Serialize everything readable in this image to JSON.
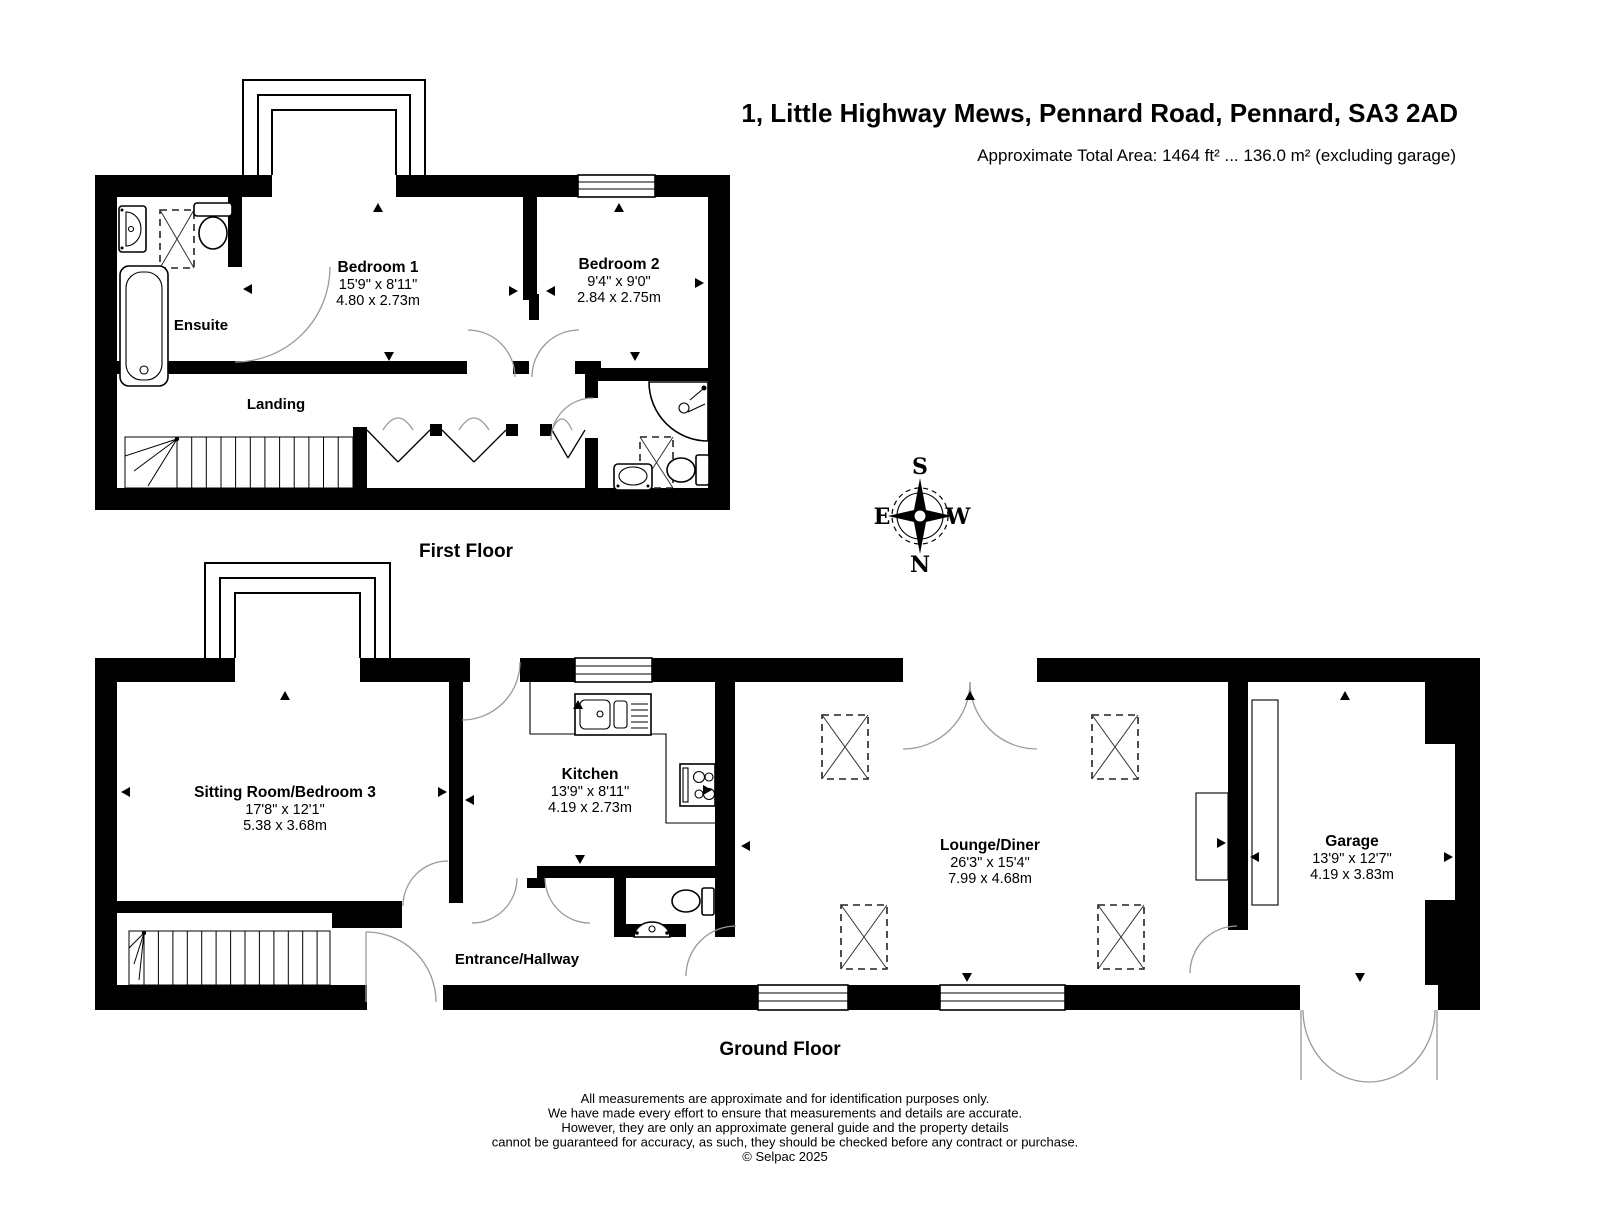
{
  "header": {
    "title": "1, Little Highway Mews, Pennard Road, Pennard, SA3 2AD",
    "area_note": "Approximate Total Area: 1464 ft² ... 136.0 m² (excluding garage)"
  },
  "compass": {
    "n": "N",
    "s": "S",
    "e": "E",
    "w": "W"
  },
  "first_floor": {
    "label": "First Floor",
    "bedroom1": {
      "name": "Bedroom 1",
      "imperial": "15'9\" x 8'11\"",
      "metric": "4.80 x 2.73m"
    },
    "bedroom2": {
      "name": "Bedroom 2",
      "imperial": "9'4\" x 9'0\"",
      "metric": "2.84 x 2.75m"
    },
    "ensuite": {
      "name": "Ensuite"
    },
    "landing": {
      "name": "Landing"
    }
  },
  "ground_floor": {
    "label": "Ground Floor",
    "sitting_room": {
      "name": "Sitting Room/Bedroom 3",
      "imperial": "17'8\" x 12'1\"",
      "metric": "5.38 x 3.68m"
    },
    "kitchen": {
      "name": "Kitchen",
      "imperial": "13'9\" x 8'11\"",
      "metric": "4.19 x 2.73m"
    },
    "entrance": {
      "name": "Entrance/Hallway"
    },
    "lounge": {
      "name": "Lounge/Diner",
      "imperial": "26'3\" x 15'4\"",
      "metric": "7.99 x 4.68m"
    },
    "garage": {
      "name": "Garage",
      "imperial": "13'9\" x 12'7\"",
      "metric": "4.19 x 3.83m"
    }
  },
  "footer": {
    "line1": "All measurements are approximate and for identification purposes only.",
    "line2": "We have made every effort to ensure that measurements and details are accurate.",
    "line3": "However, they are only an approximate general guide and the property details",
    "line4": "cannot be guaranteed for accuracy, as such, they should be checked before any contract or purchase.",
    "copyright": "© Selpac 2025"
  },
  "colors": {
    "wall": "#000000",
    "background": "#ffffff",
    "door_arc": "#999999"
  }
}
